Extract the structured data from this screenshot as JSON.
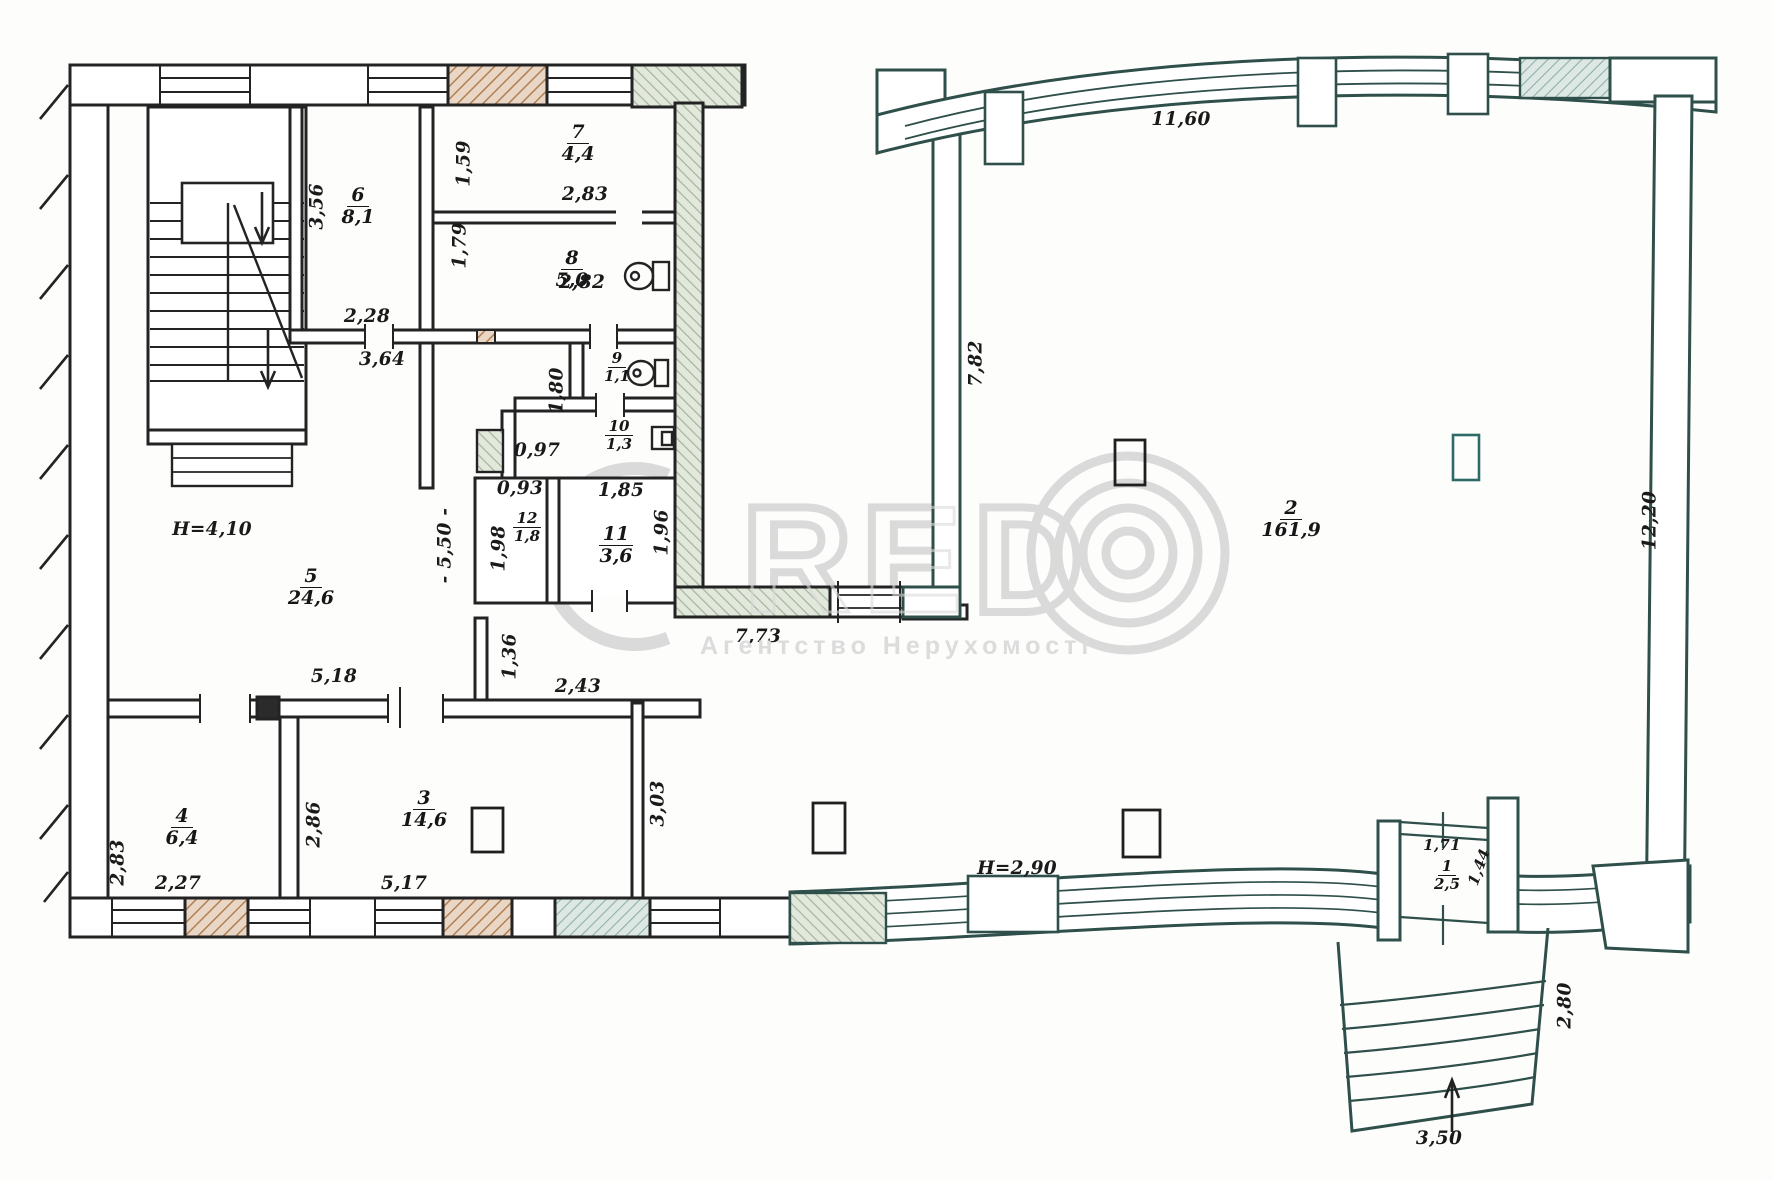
{
  "document": {
    "type": "floor-plan",
    "units": "meters"
  },
  "watermark": {
    "prefix": "C",
    "letters": "RED",
    "subtitle": "Агентство Нерухомості",
    "color": "#d9d9d9"
  },
  "colors": {
    "line": "#232323",
    "line_right_wing": "#2f4f4a",
    "hatch_brown": "#b08055",
    "hatch_green": "#a3b49a",
    "hatch_teal": "#8fb0a8",
    "watermark": "#d9d9d9",
    "paper": "#fdfdfc"
  },
  "rooms": {
    "r1": {
      "number": "1",
      "area": "2,5"
    },
    "r2": {
      "number": "2",
      "area": "161,9"
    },
    "r3": {
      "number": "3",
      "area": "14,6"
    },
    "r4": {
      "number": "4",
      "area": "6,4"
    },
    "r5": {
      "number": "5",
      "area": "24,6"
    },
    "r6": {
      "number": "6",
      "area": "8,1"
    },
    "r7": {
      "number": "7",
      "area": "4,4"
    },
    "r8": {
      "number": "8",
      "area": "5,0"
    },
    "r9": {
      "number": "9",
      "area": "1,1"
    },
    "r10": {
      "number": "10",
      "area": "1,3"
    },
    "r11": {
      "number": "11",
      "area": "3,6"
    },
    "r12": {
      "number": "12",
      "area": "1,8"
    }
  },
  "dimensions": {
    "r7_left": "1,59",
    "r7_width": "2,83",
    "r6_left": "3,56",
    "r6_width": "2,28",
    "hall_364": "3,64",
    "r8_left": "1,79",
    "r8_width": "2,82",
    "corr_180": "1,80",
    "step_097": "0,97",
    "r12_width": "0,93",
    "r11_width": "1,85",
    "r12_left": "1,98",
    "r11_right": "1,96",
    "hall_550": "- 5,50 -",
    "height_left": "Н=4,10",
    "r5_width": "5,18",
    "pass_136": "1,36",
    "r3_top": "2,43",
    "r4_left": "2,83",
    "r4_right": "2,86",
    "r4_width": "2,27",
    "r3_width": "5,17",
    "r3_right": "3,03",
    "link_773": "7,73",
    "hall2_top": "11,60",
    "hall2_left": "7,82",
    "hall2_right": "12,20",
    "height_hall": "Н=2,90",
    "r1_width": "1,71",
    "r1_depth": "1,44",
    "porch_depth": "2,80",
    "porch_width": "3,50"
  }
}
